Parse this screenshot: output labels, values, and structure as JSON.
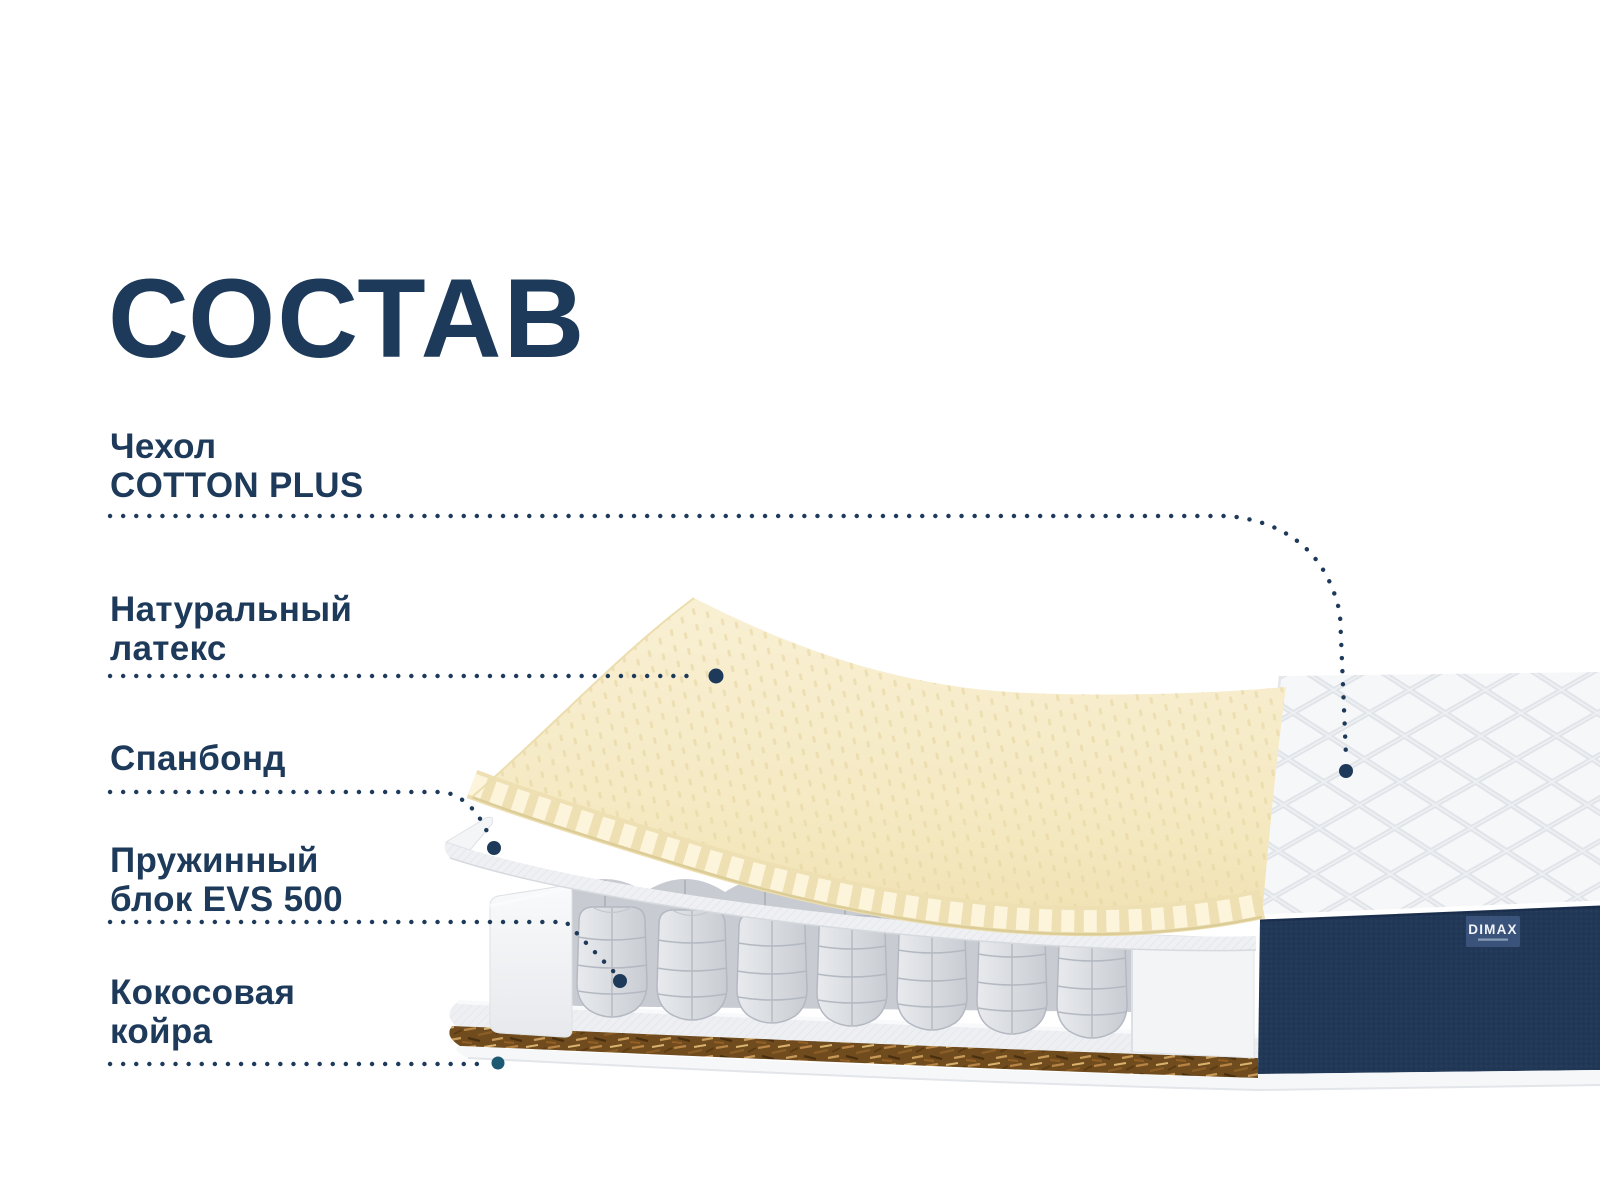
{
  "title": "СОСТАВ",
  "labels": {
    "cover": {
      "line1": "Чехол",
      "line2": "COTTON PLUS"
    },
    "latex": {
      "line1": "Натуральный",
      "line2": "латекс"
    },
    "spunbond": {
      "line1": "Спанбонд"
    },
    "springs": {
      "line1": "Пружинный",
      "line2": "блок EVS 500"
    },
    "coir": {
      "line1": "Кокосовая",
      "line2": "койра"
    }
  },
  "brand": {
    "logo": "DIMAX"
  },
  "colors": {
    "accent_navy": "#1e3a5a",
    "latex_cream": "#f5eac4",
    "spunbond_grey": "#eef0f3",
    "spring_grey": "#d7dade",
    "coir_brown": "#6f4b1d",
    "side_fabric_navy": "#223857",
    "quilt_white": "#f6f7f9",
    "leader_dot_teal": "#1c5a73"
  }
}
